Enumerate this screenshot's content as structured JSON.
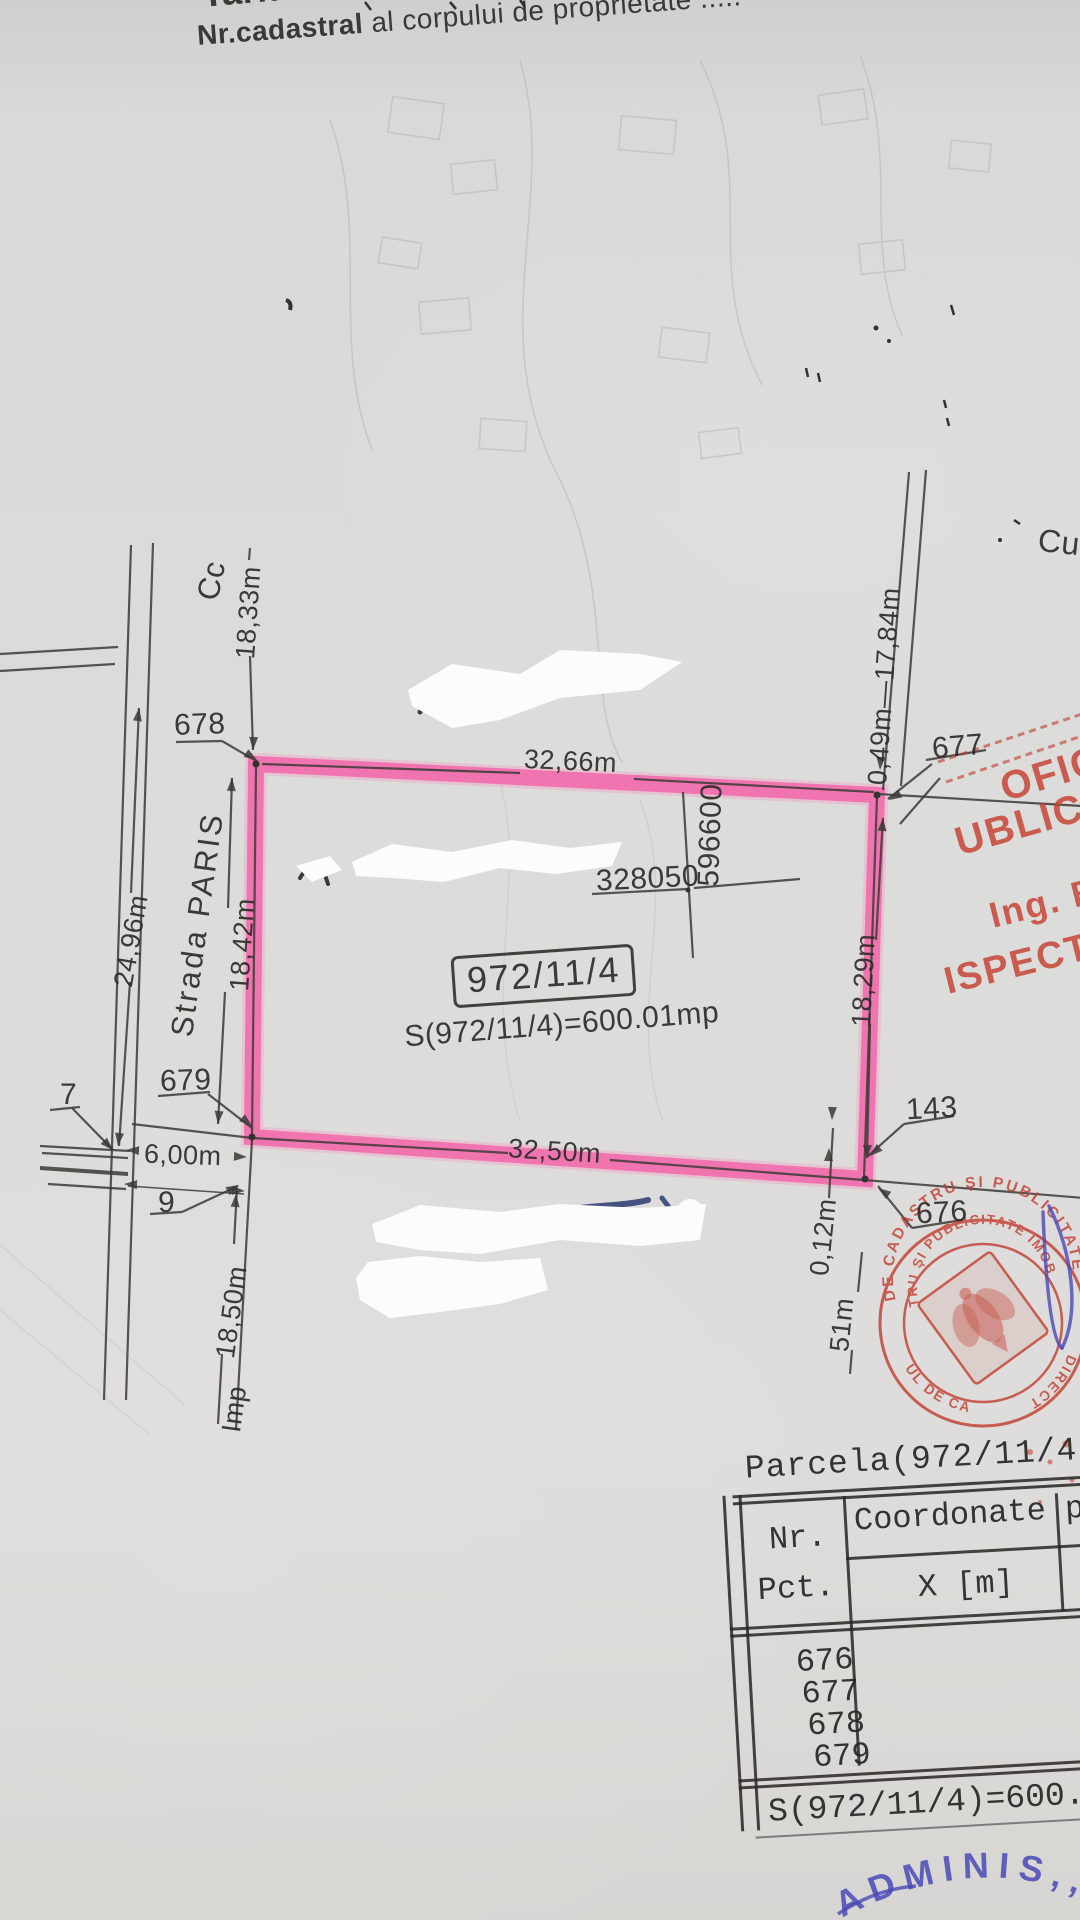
{
  "colors": {
    "highlight_pink": "#ee55a0",
    "ink": "#3c3a36",
    "stamp_red": "#c0392b",
    "pen_blue": "#4a4ab6"
  },
  "header": {
    "tarlaua": "Tarlaua",
    "cadastral_bold": "Nr.cadastral",
    "cadastral_rest": " al corpului de proprietate ....."
  },
  "map": {
    "street_name": "Strada PARIS",
    "zone_cc": "Cc",
    "zone_cu": "Cu",
    "parcel_number": "972/11/4",
    "parcel_area": "S(972/11/4)=600.01mp",
    "grid_x": "328050",
    "grid_y": "596600",
    "pt_676": "676",
    "pt_677": "677",
    "pt_678": "678",
    "pt_679": "679",
    "pt_143": "143",
    "pt_7": "7",
    "pt_9": "9",
    "dim_top": "32,66m",
    "dim_bottom": "32,50m",
    "dim_left_outer": "24,96m",
    "dim_left": "18,42m",
    "dim_left_top": "18,33m",
    "dim_right": "18,29m",
    "dim_right_top": "0,49m—17,84m",
    "dim_gap": "6,00m",
    "dim_offset": "0,12m",
    "dim_bottom_left_prefix": "Imp",
    "dim_bottom_left": "18,50m",
    "dim_right_lower": "51m"
  },
  "stamps": {
    "office_line1": "OFICI",
    "office_line2": "UBLICIT",
    "office_line3": "Ing. BU",
    "office_line4": "ISPECTOR",
    "round_outer_top": "DE CADASTRU ŞI PUBLICITATE",
    "round_outer_bottom": "UL DE CA",
    "round_right": "DIRECT",
    "round_inner_top": "TRU ŞI PUBLICITATE IMOB",
    "blue_note": "ADMINIS,,"
  },
  "table": {
    "title": "Parcela(972/11/4)",
    "col_point_l1": "Nr.",
    "col_point_l2": "Pct.",
    "col_coord": "Coordonate pct",
    "col_x": "X [m]",
    "rows": [
      "676",
      "677",
      "678",
      "679"
    ],
    "area_row": "S(972/11/4)=600.0"
  }
}
